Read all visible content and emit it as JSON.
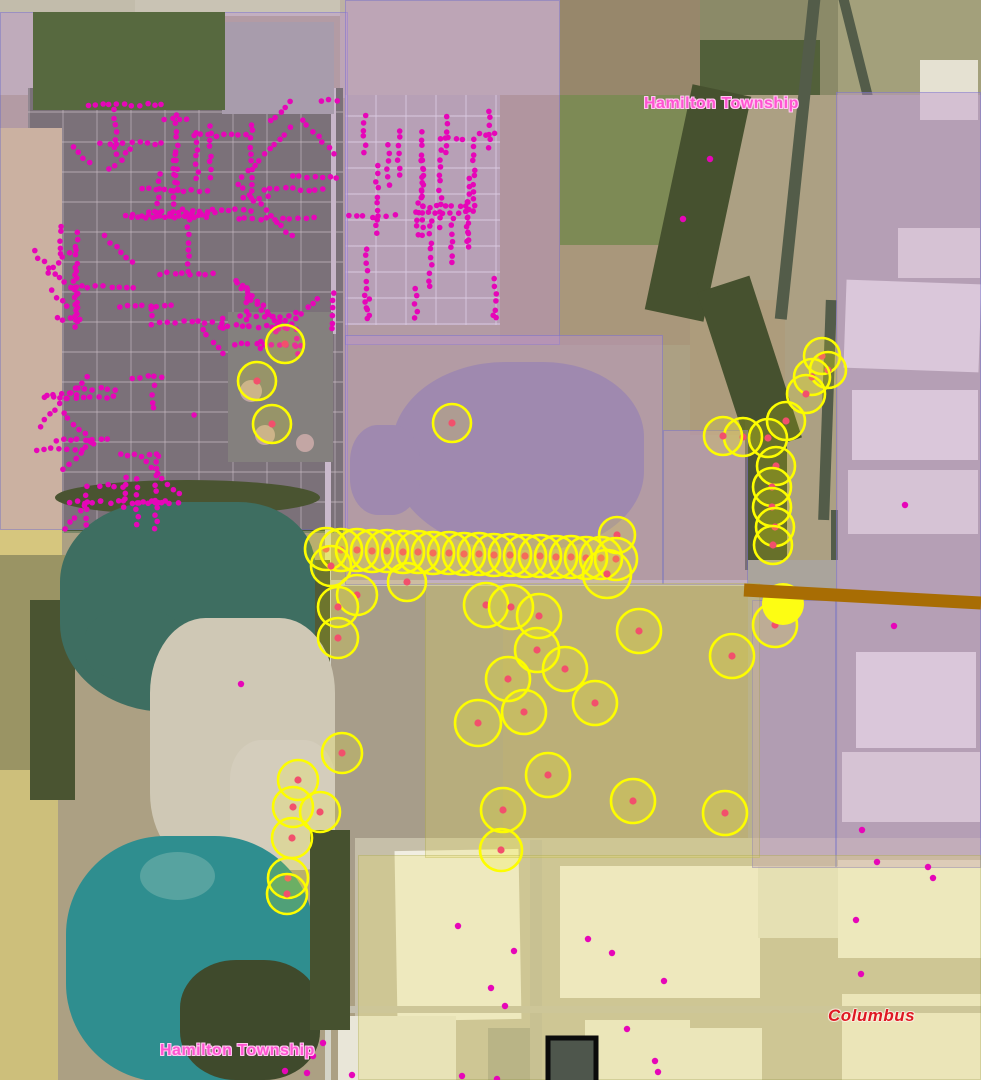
{
  "map": {
    "size": {
      "w": 981,
      "h": 1080
    },
    "labels": [
      {
        "id": "township-label-top",
        "text": "Hamilton Township",
        "x": 644,
        "y": 95,
        "color": "#ff54d2",
        "halo": "#ffc9f1",
        "size": 16,
        "italic": false
      },
      {
        "id": "township-label-bottom",
        "text": "Hamilton Township",
        "x": 160,
        "y": 1042,
        "color": "#ff54d2",
        "halo": "#ffc9f1",
        "size": 16,
        "italic": false
      },
      {
        "id": "columbus-label",
        "text": "Columbus",
        "x": 828,
        "y": 1006,
        "color": "#de1822",
        "halo": "rgba(255,245,235,0.45)",
        "size": 17,
        "italic": true
      }
    ],
    "colors": {
      "buffer_stroke": "#fdfd00",
      "buffer_fill": "rgba(255,255,0,0.16)",
      "buffer_center": "#f2506c",
      "solid_circle_fill": "#fdfd13",
      "address_dot": "#e606b8",
      "township_overlay": "rgba(188,148,210,0.42)",
      "industrial_overlay": "rgba(232,220,90,0.26)",
      "pipeline": "#a86d04",
      "selection_stroke": "#0b0b0b",
      "selection_fill": "#4e564c"
    },
    "zones": {
      "township": [
        {
          "x": 0,
          "y": 12,
          "w": 348,
          "h": 518
        },
        {
          "x": 345,
          "y": 0,
          "w": 215,
          "h": 345
        },
        {
          "x": 345,
          "y": 335,
          "w": 318,
          "h": 250
        },
        {
          "x": 663,
          "y": 430,
          "w": 85,
          "h": 155
        },
        {
          "x": 836,
          "y": 92,
          "w": 145,
          "h": 776
        },
        {
          "x": 752,
          "y": 600,
          "w": 84,
          "h": 268
        }
      ],
      "industrial": [
        {
          "x": 425,
          "y": 583,
          "w": 335,
          "h": 275
        },
        {
          "x": 358,
          "y": 855,
          "w": 623,
          "h": 225
        }
      ]
    },
    "buffer_circles": [
      [
        285,
        344,
        19
      ],
      [
        257,
        381,
        19
      ],
      [
        272,
        424,
        19
      ],
      [
        452,
        423,
        19
      ],
      [
        617,
        535,
        18
      ],
      [
        326,
        549,
        21
      ],
      [
        341,
        550,
        21
      ],
      [
        357,
        550,
        21
      ],
      [
        372,
        551,
        21
      ],
      [
        387,
        551,
        21
      ],
      [
        403,
        552,
        21
      ],
      [
        418,
        552,
        21
      ],
      [
        433,
        553,
        21
      ],
      [
        449,
        553,
        21
      ],
      [
        464,
        554,
        21
      ],
      [
        479,
        554,
        21
      ],
      [
        494,
        555,
        21
      ],
      [
        510,
        555,
        21
      ],
      [
        525,
        556,
        21
      ],
      [
        540,
        556,
        21
      ],
      [
        556,
        557,
        21
      ],
      [
        571,
        557,
        21
      ],
      [
        586,
        558,
        21
      ],
      [
        601,
        558,
        21
      ],
      [
        616,
        559,
        21
      ],
      [
        331,
        566,
        20
      ],
      [
        607,
        574,
        24
      ],
      [
        407,
        582,
        19
      ],
      [
        357,
        595,
        20
      ],
      [
        338,
        607,
        20
      ],
      [
        338,
        638,
        20
      ],
      [
        342,
        753,
        20
      ],
      [
        298,
        780,
        20
      ],
      [
        293,
        807,
        20
      ],
      [
        320,
        812,
        20
      ],
      [
        292,
        838,
        20
      ],
      [
        288,
        878,
        20
      ],
      [
        287,
        894,
        20
      ],
      [
        486,
        605,
        22
      ],
      [
        511,
        607,
        22
      ],
      [
        539,
        616,
        22
      ],
      [
        537,
        650,
        22
      ],
      [
        565,
        669,
        22
      ],
      [
        508,
        679,
        22
      ],
      [
        524,
        712,
        22
      ],
      [
        595,
        703,
        22
      ],
      [
        478,
        723,
        23
      ],
      [
        639,
        631,
        22
      ],
      [
        732,
        656,
        22
      ],
      [
        548,
        775,
        22
      ],
      [
        503,
        810,
        22
      ],
      [
        633,
        801,
        22
      ],
      [
        725,
        813,
        22
      ],
      [
        501,
        850,
        21
      ],
      [
        822,
        356,
        18
      ],
      [
        828,
        370,
        18
      ],
      [
        812,
        377,
        18
      ],
      [
        806,
        394,
        19
      ],
      [
        786,
        421,
        19
      ],
      [
        768,
        438,
        19
      ],
      [
        743,
        437,
        19
      ],
      [
        723,
        436,
        19
      ],
      [
        776,
        466,
        19
      ],
      [
        772,
        487,
        19
      ],
      [
        772,
        507,
        19
      ],
      [
        775,
        527,
        19
      ],
      [
        773,
        545,
        19
      ],
      [
        775,
        625,
        22
      ]
    ],
    "solid_circle": [
      783,
      604,
      21
    ],
    "pipeline": {
      "x1": 744,
      "y1": 590,
      "x2": 981,
      "y2": 603,
      "width": 13
    },
    "selection_rect": {
      "x": 548,
      "y": 1038,
      "w": 48,
      "h": 50,
      "stroke_width": 5
    },
    "address_dots": {
      "radius": 2.8,
      "clusters": [
        {
          "x": 32,
          "y": 95,
          "w": 306,
          "h": 235,
          "count": 360,
          "seed": 11,
          "orient": "mixed"
        },
        {
          "x": 30,
          "y": 330,
          "w": 165,
          "h": 200,
          "count": 140,
          "seed": 22,
          "orient": "mixed"
        },
        {
          "x": 195,
          "y": 300,
          "w": 120,
          "h": 55,
          "count": 40,
          "seed": 33,
          "orient": "mixed"
        },
        {
          "x": 348,
          "y": 105,
          "w": 150,
          "h": 215,
          "count": 175,
          "seed": 44,
          "orient": "vertical"
        }
      ],
      "singles": [
        [
          241,
          684
        ],
        [
          323,
          1043
        ],
        [
          313,
          1056
        ],
        [
          285,
          1071
        ],
        [
          307,
          1073
        ],
        [
          352,
          1075
        ],
        [
          458,
          926
        ],
        [
          514,
          951
        ],
        [
          491,
          988
        ],
        [
          505,
          1006
        ],
        [
          588,
          939
        ],
        [
          612,
          953
        ],
        [
          627,
          1029
        ],
        [
          664,
          981
        ],
        [
          655,
          1061
        ],
        [
          658,
          1072
        ],
        [
          462,
          1076
        ],
        [
          497,
          1079
        ],
        [
          710,
          159
        ],
        [
          683,
          219
        ],
        [
          905,
          505
        ],
        [
          894,
          626
        ],
        [
          862,
          830
        ],
        [
          877,
          862
        ],
        [
          856,
          920
        ],
        [
          861,
          974
        ],
        [
          928,
          867
        ],
        [
          933,
          878
        ]
      ]
    }
  }
}
